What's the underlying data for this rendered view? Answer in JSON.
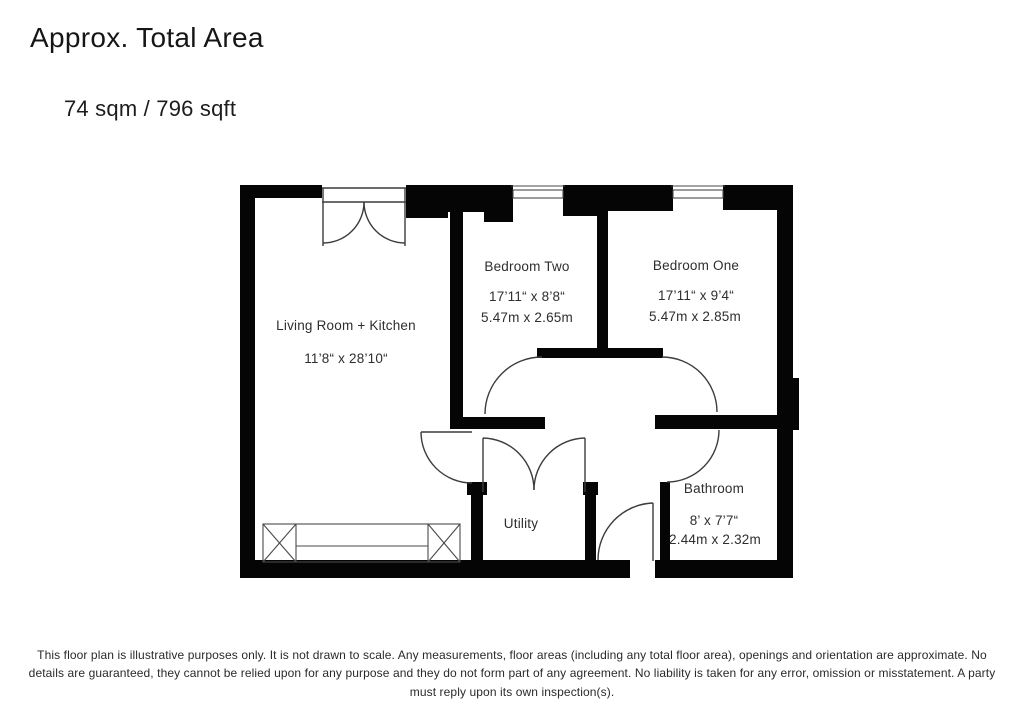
{
  "header": {
    "title": "Approx. Total Area",
    "total_area": "74 sqm / 796 sqft"
  },
  "rooms": {
    "living": {
      "name": "Living Room + Kitchen",
      "imperial": "11’8“ x 28’10“"
    },
    "bedroom_two": {
      "name": "Bedroom Two",
      "imperial": "17’11“ x 8’8“",
      "metric": "5.47m x 2.65m"
    },
    "bedroom_one": {
      "name": "Bedroom One",
      "imperial": "17’11“ x 9’4“",
      "metric": "5.47m x 2.85m"
    },
    "utility": {
      "name": "Utility"
    },
    "bathroom": {
      "name": "Bathroom",
      "imperial": "8’ x 7’7“",
      "metric": "2.44m x 2.32m"
    }
  },
  "colors": {
    "wall": "#050505",
    "symbol_line": "#3c3c3c",
    "text": "#2e2e2e"
  },
  "footer": {
    "lines": [
      "This floor plan is illustrative purposes only. It is not drawn to scale. Any measurements, floor areas (including any total floor area), openings and orientation are approximate. No",
      "details are guaranteed, they cannot be relied upon for any purpose and they do not form part of any agreement. No liability is taken for any error, omission or misstatement. A party",
      "must reply upon its own inspection(s)."
    ]
  }
}
